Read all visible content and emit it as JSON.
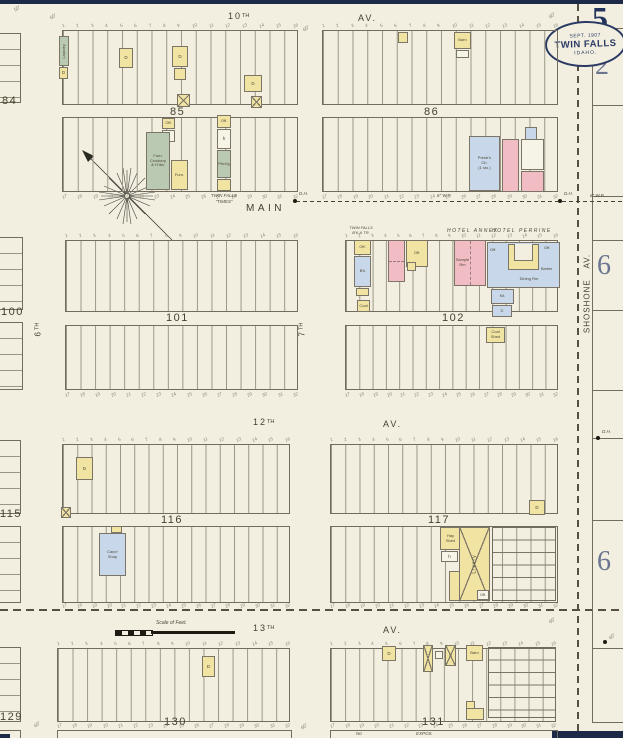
{
  "margin": {
    "sheet_number": "5",
    "adjoining_number_2": "2",
    "adjoining_number_6a": "6",
    "adjoining_number_6b": "6"
  },
  "stamp": {
    "date": "SEPT. 1907",
    "city": "TWIN FALLS",
    "state": "IDAHO."
  },
  "streets": {
    "tenth_num": "10",
    "tenth_suf": "TH",
    "twelfth_num": "12",
    "twelfth_suf": "TH",
    "thirteenth_num": "13",
    "thirteenth_suf": "TH",
    "sixth_num": "6",
    "sixth_suf": "TH",
    "seventh_num": "7",
    "seventh_suf": "TH",
    "avenue": "AV.",
    "main": "MAIN",
    "shoshone": "SHOSHONE AV."
  },
  "blocks": {
    "b84": "84",
    "b85": "85",
    "b86": "86",
    "b100": "100",
    "b101": "101",
    "b102": "102",
    "b115": "115",
    "b116": "116",
    "b117": "117",
    "b129": "129",
    "b130": "130",
    "b131": "131"
  },
  "lots": {
    "north": [
      "1",
      "2",
      "3",
      "4",
      "5",
      "6",
      "7",
      "8",
      "9",
      "10",
      "11",
      "12",
      "13",
      "14",
      "15",
      "16"
    ],
    "south": [
      "17",
      "18",
      "19",
      "20",
      "21",
      "22",
      "23",
      "24",
      "25",
      "26",
      "27",
      "28",
      "29",
      "30",
      "31",
      "32"
    ]
  },
  "labels": {
    "hotel_annex": "HOTEL ANNEX",
    "hotel_perrine": "HOTEL PERRINE",
    "bank_l1": "TWIN FALLS",
    "bank_l2": "B'K & TR.",
    "times_l1": "TWIN FALLS",
    "times_l2": "“TIMES”",
    "no_expos_1": "No",
    "no_expos_2": "EXPOS.",
    "scale": "Scale of Feet.",
    "water_pipe": "6\" W.P.",
    "hydrant": "D.H."
  },
  "codes": {
    "d": "D",
    "h": "h",
    "off": "Off."
  },
  "buildings": {
    "laundry": "Laundry",
    "furn_store": "Furn.\nCrockery\n& H'dw.",
    "furn": "Furn.",
    "printing": "Print'g",
    "bank": "B'k",
    "sample": "Sample\nRm",
    "dining": "Dining Rm",
    "barber": "Barber",
    "kitchen": "Kit.",
    "church": "Presb'n\nCh.\n(1 sto.)",
    "barn": "Barn",
    "coal": "Coal",
    "coal_shed": "Coal\nShed",
    "carpenter": "Carp'r\nShop",
    "hay_shed": "Hay\nShed",
    "livery": "Livery"
  },
  "dims": {
    "fifty": "50'",
    "sixty": "60'"
  },
  "colors": {
    "paper": "#f2efe1",
    "line": "#716c5d",
    "yellow": "#f1e4a3",
    "pink": "#f2bcc4",
    "blue": "#c8d7ea",
    "green": "#bac9b2",
    "navy": "#1c2947",
    "ink": "#524d3c"
  }
}
